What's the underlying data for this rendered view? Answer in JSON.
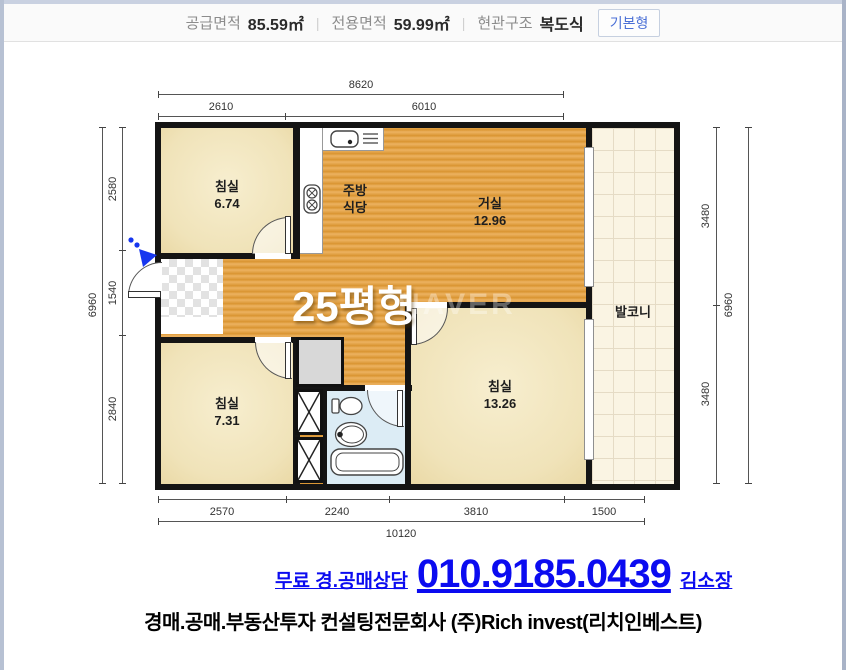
{
  "header": {
    "supply_label": "공급면적",
    "supply_value": "85.59㎡",
    "separator": "|",
    "exclusive_label": "전용면적",
    "exclusive_value": "59.99㎡",
    "entrance_label": "현관구조",
    "entrance_value": "복도식",
    "type_button": "기본형"
  },
  "plan": {
    "size_label": "25평형",
    "watermark": "NAVER",
    "rooms": {
      "bedroom1": {
        "name": "침실",
        "area": "6.74"
      },
      "kitchen": {
        "line1": "주방",
        "line2": "식당"
      },
      "living": {
        "name": "거실",
        "area": "12.96"
      },
      "balcony": {
        "name": "발코니"
      },
      "bedroom2": {
        "name": "침실",
        "area": "7.31"
      },
      "bedroom3": {
        "name": "침실",
        "area": "13.26"
      }
    },
    "dims": {
      "top_total": "8620",
      "top_seg1": "2610",
      "top_seg2": "6010",
      "left_total": "6960",
      "left_seg1": "2580",
      "left_seg2": "1540",
      "left_seg3": "2840",
      "right_seg1": "3480",
      "right_seg2": "3480",
      "right_total": "6960",
      "bottom_seg1": "2570",
      "bottom_seg2": "2240",
      "bottom_seg3": "3810",
      "bottom_seg4": "1500",
      "bottom_total": "10120"
    },
    "icons": [
      "entrance-arrow-icon",
      "sink-icon",
      "stove-icon",
      "toilet-icon",
      "washbasin-icon",
      "bathtub-icon",
      "closet-x-icon"
    ]
  },
  "contact": {
    "prefix": "무료 경.공매상담",
    "phone": "010.9185.0439",
    "agent": "김소장",
    "company": "경매.공매.부동산투자 컨설팅전문회사 (주)Rich invest(리치인베스트)"
  },
  "colors": {
    "accent_blue": "#0b0bf0",
    "wall": "#141414",
    "wood": "#e0a044",
    "cream": "#f1e4bb",
    "bath": "#dcecf5",
    "balcony": "#faf4e3"
  }
}
